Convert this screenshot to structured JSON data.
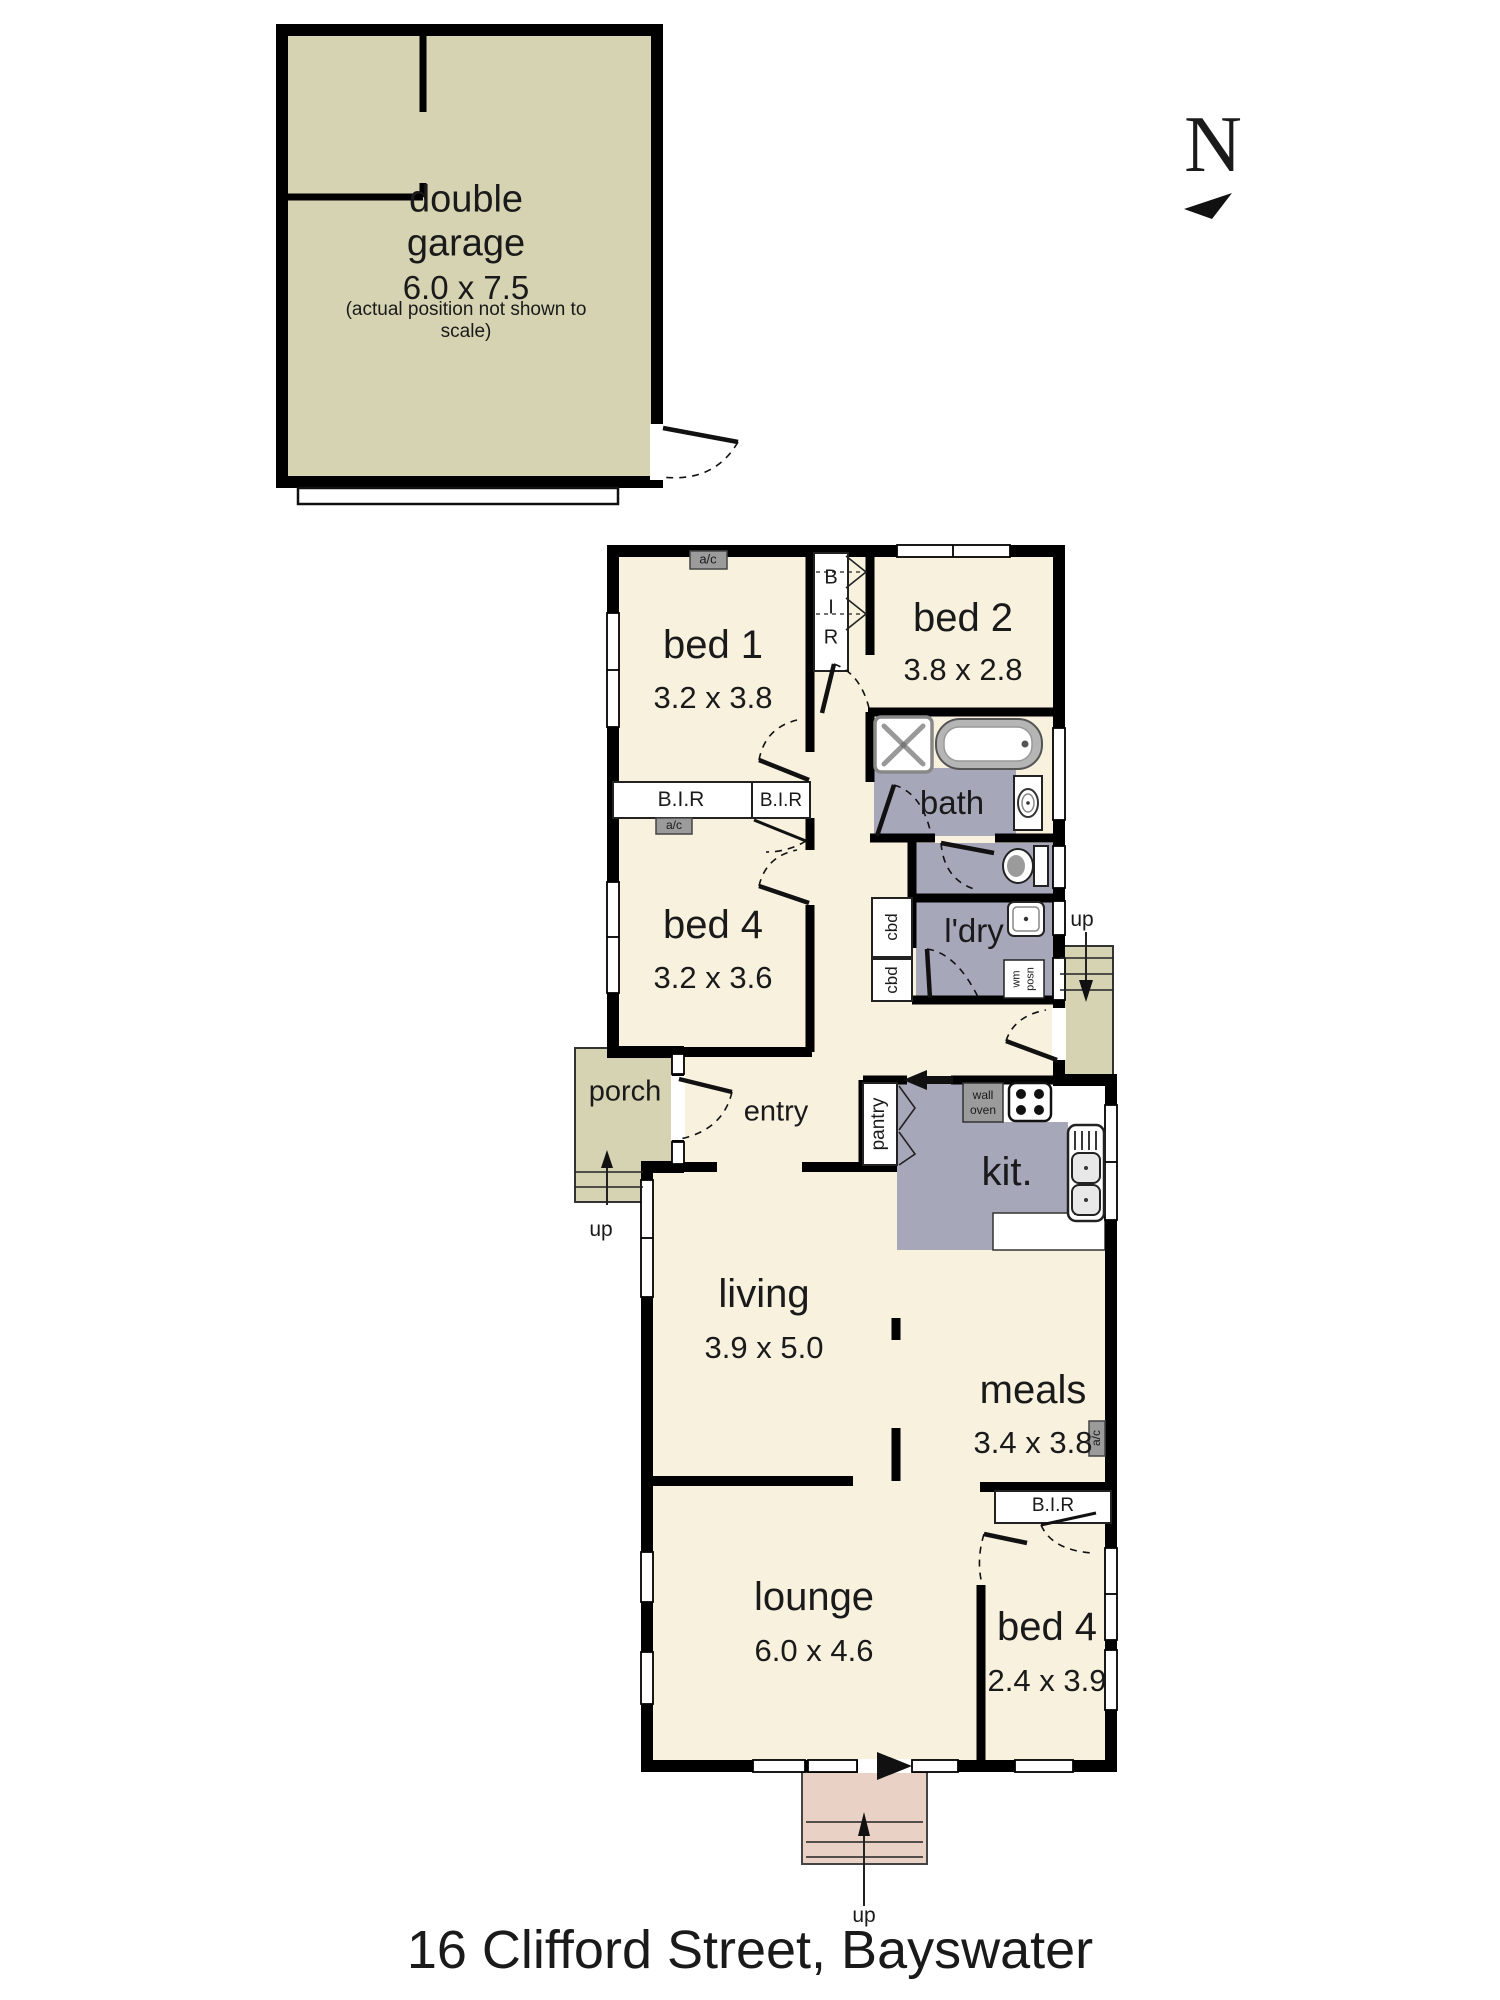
{
  "title": "16 Clifford Street, Bayswater",
  "compass": {
    "letter": "N"
  },
  "garage": {
    "name": "double garage",
    "dims": "6.0 x 7.5",
    "note": "(actual position not shown to scale)"
  },
  "rooms": {
    "bed1": {
      "name": "bed 1",
      "dims": "3.2 x 3.8"
    },
    "bed2": {
      "name": "bed 2",
      "dims": "3.8 x 2.8"
    },
    "bed4_middle": {
      "name": "bed 4",
      "dims": "3.2 x 3.6"
    },
    "living": {
      "name": "living",
      "dims": "3.9 x 5.0"
    },
    "meals": {
      "name": "meals",
      "dims": "3.4 x 3.8"
    },
    "lounge": {
      "name": "lounge",
      "dims": "6.0 x 4.6"
    },
    "bed4_rear": {
      "name": "bed 4",
      "dims": "2.4 x 3.9"
    },
    "bath": {
      "name": "bath"
    },
    "laundry": {
      "name": "l'dry"
    },
    "kitchen": {
      "name": "kit."
    },
    "entry": {
      "name": "entry"
    },
    "porch": {
      "name": "porch"
    }
  },
  "fixtures": {
    "bir": "B.I.R",
    "bir_letters": [
      "B",
      "I",
      "R"
    ],
    "cbd": "cbd",
    "pantry": "pantry",
    "wall_oven": [
      "wall",
      "oven"
    ],
    "wm_posn": [
      "wm",
      "posn"
    ],
    "ac": "a/c",
    "up": "up"
  },
  "colors": {
    "floor_cream": "#f7f1de",
    "outdoor_khaki": "#d6d3b2",
    "wet_gray": "#a6a8ba",
    "steps_pink": "#e9d1c5",
    "appliance_gray": "#9b9b9b",
    "wall_black": "#000000"
  }
}
